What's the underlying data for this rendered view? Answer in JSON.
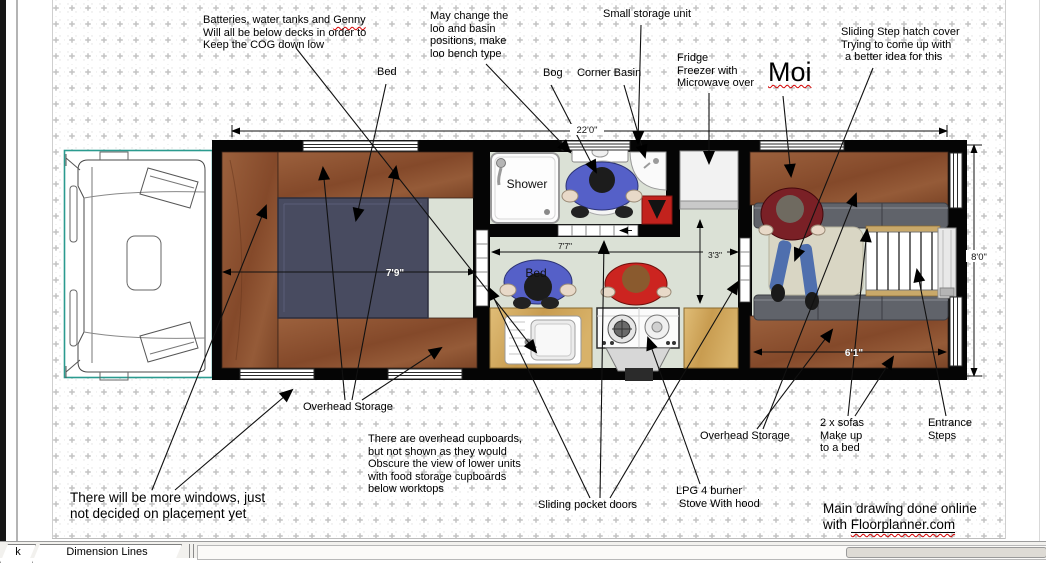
{
  "annotations": {
    "batteries": {
      "line1_pre": "Batteries, water tanks and ",
      "line1_word": "Genny",
      "line2": "Will all be below decks in order to",
      "line3": "Keep the COG down low"
    },
    "may_change": {
      "lines": [
        "May change the",
        "loo and basin",
        "positions, make",
        "loo bench type"
      ]
    },
    "small_storage": {
      "label": "Small storage unit"
    },
    "sliding_step": {
      "lines": [
        "Sliding Step hatch cover",
        "Trying to come up with",
        "a better idea for this"
      ]
    },
    "bed": {
      "label": "Bed"
    },
    "bog": {
      "label": "Bog"
    },
    "corner_basin": {
      "label": "Corner Basin"
    },
    "fridge": {
      "lines": [
        "Fridge",
        "Freezer with",
        "Microwave over"
      ]
    },
    "moi": {
      "label": "Moi"
    },
    "overhead_storage_left": {
      "label": "Overhead Storage"
    },
    "overhead_storage_right": {
      "label": "Overhead Storage"
    },
    "cupboards_note": {
      "lines": [
        "There are overhead cupboards,",
        "but not shown as they would",
        "Obscure the view of lower units",
        "with food storage cupboards",
        "below worktops"
      ]
    },
    "windows_note": {
      "lines": [
        "There will be more windows, just",
        "not decided on placement yet"
      ]
    },
    "sliding_doors": {
      "label": "Sliding  pocket doors"
    },
    "lpg": {
      "lines": [
        "LPG 4 burner",
        "Stove With hood"
      ]
    },
    "sofas_note": {
      "lines": [
        "2 x sofas",
        "Make up",
        "to a bed"
      ]
    },
    "entrance": {
      "lines": [
        "Entrance",
        "Steps"
      ]
    },
    "credit": {
      "line1": "Main drawing done online",
      "line2_pre": "with ",
      "link": "Floorplanner.com"
    }
  },
  "plan": {
    "shower_label": "Shower",
    "bed_item_label": "Bed",
    "dimensions": {
      "total_width": "22'0\"",
      "hall_width": "7'7\"",
      "storage_depth": "3'3\"",
      "height": "8'0\"",
      "bed_width": "7'9\"",
      "sofa_length": "6'1\""
    }
  },
  "statusbar": {
    "tabs": [
      {
        "label": "k"
      },
      {
        "label": "Dimension Lines"
      }
    ]
  },
  "colors": {
    "wall": "#000000",
    "floor": "#dbe1d6",
    "wood_cabinet": "#8f5736",
    "counter_wood": "#d4ac62",
    "bed": "#484b60",
    "sofa": "#60636a",
    "table": "#d9d6c4",
    "cab_outline_teal": "#2b9b8f",
    "red_mat": "#c2221d",
    "spellcheck_red": "#d40000"
  }
}
